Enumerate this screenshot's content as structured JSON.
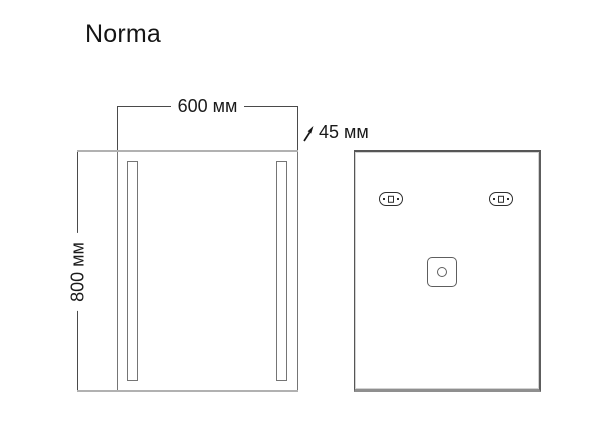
{
  "title": "Norma",
  "dimensions": {
    "width": "600 мм",
    "height": "800 мм",
    "depth": "45 мм"
  },
  "icons": {
    "depth_arrow": "arrow-up-right"
  },
  "colors": {
    "background": "#ffffff",
    "dimension_line": "#4a4a4a",
    "extension_line": "#b1b1b1",
    "drawing_outline": "#757575",
    "bracket_outline": "#2e2e2e",
    "text": "#1a1a1a"
  }
}
